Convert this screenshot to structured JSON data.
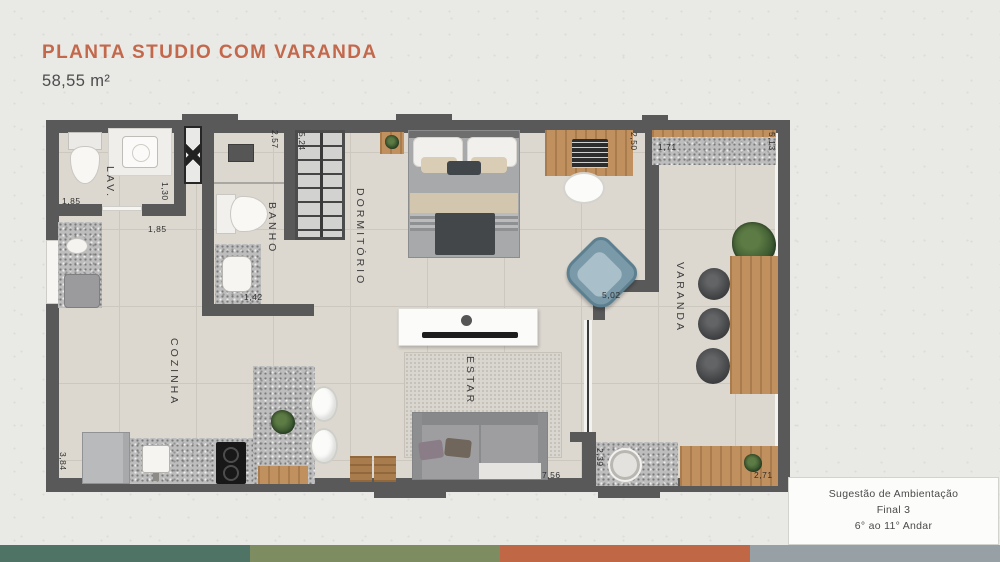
{
  "header": {
    "title": "PLANTA STUDIO COM VARANDA",
    "area": "58,55 m²"
  },
  "plan": {
    "rooms": {
      "lav": "LAV.",
      "banho": "BANHO",
      "dormitorio": "DORMITÓRIO",
      "cozinha": "COZINHA",
      "estar": "ESTAR",
      "varanda": "VARANDA"
    },
    "dims": {
      "lav_width": "1,85",
      "lav_depth": "1,30",
      "hall_width": "1,85",
      "banho_depth": "2,57",
      "closet_depth": "5,24",
      "banho_width": "1,42",
      "desk_wall": "2,50",
      "varanda_counter": "1,71",
      "varanda_depth": "5,13",
      "varanda_door": "5,02",
      "estar_width": "7,56",
      "cozinha_depth": "3,84",
      "varanda_sink": "2,39",
      "varanda_bench": "2,71"
    }
  },
  "caption": {
    "line1": "Sugestão de Ambientação",
    "line2": "Final 3",
    "line3": "6° ao 11° Andar"
  },
  "colors": {
    "accent": "#c4684c"
  },
  "footer": {
    "colors": [
      "#4f7465",
      "#7e8c62",
      "#c06845",
      "#97a0a4"
    ]
  }
}
